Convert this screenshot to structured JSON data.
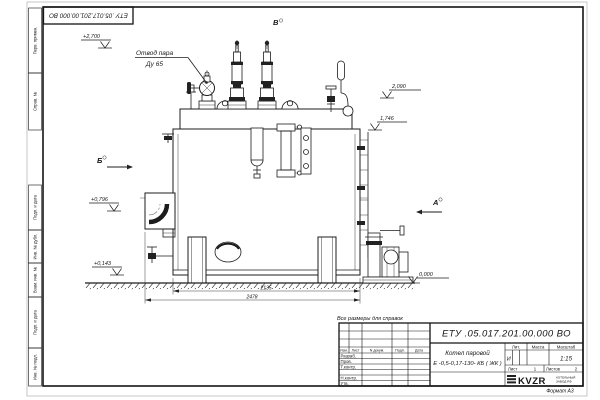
{
  "colors": {
    "ink": "#1c1c1c",
    "paper": "#ffffff"
  },
  "stamp": {
    "doc_number_rotated": "ЕТУ .05.017.201.00.000 ВО"
  },
  "margin_boxes": [
    "Перв. примен.",
    "Справ. №",
    "Подп. и дата",
    "Инв. № дубл.",
    "Взам. инв. №",
    "Подп. и дата",
    "Инв. № подл."
  ],
  "callouts": {
    "steam_line1": "Отвод пара",
    "steam_line2": "Ду 65",
    "view_top": "В",
    "view_left": "Б",
    "view_right": "А",
    "lv_2700": "+2,700",
    "lv_2090": "2,090",
    "lv_1746": "1,746",
    "lv_0796": "+0,796",
    "lv_0143": "+0,143",
    "lv_0000": "0,000",
    "dim_width": "2135",
    "dim_total": "2478",
    "ref_note": "Все размеры для справок"
  },
  "title_block": {
    "doc_number": "ЕТУ .05.017.201.00.000 ВО",
    "product_line1": "Котел паровой",
    "product_line2": "Е -0,5-0,17-130- КБ ( ЖК )",
    "cols": [
      "Изм.",
      "Лист",
      "N докум.",
      "Подп.",
      "Дата"
    ],
    "row_labels": [
      "Разраб.",
      "Пров.",
      "Т.контр.",
      "Н.контр.",
      "Утв."
    ],
    "lit_label": "Лит.",
    "lit_value": "И",
    "mass_label": "Масса",
    "scale_label": "Масштаб",
    "scale_value": "1:15",
    "sheet_label": "Лист",
    "sheet_value": "1",
    "sheets_label": "Листов",
    "sheets_value": "2",
    "logo_text": "KVZR",
    "logo_caption_line1": "КОТЕЛЬНЫЙ",
    "logo_caption_line2": "ЗАВОД РФ",
    "format_note": "Формат А3"
  }
}
